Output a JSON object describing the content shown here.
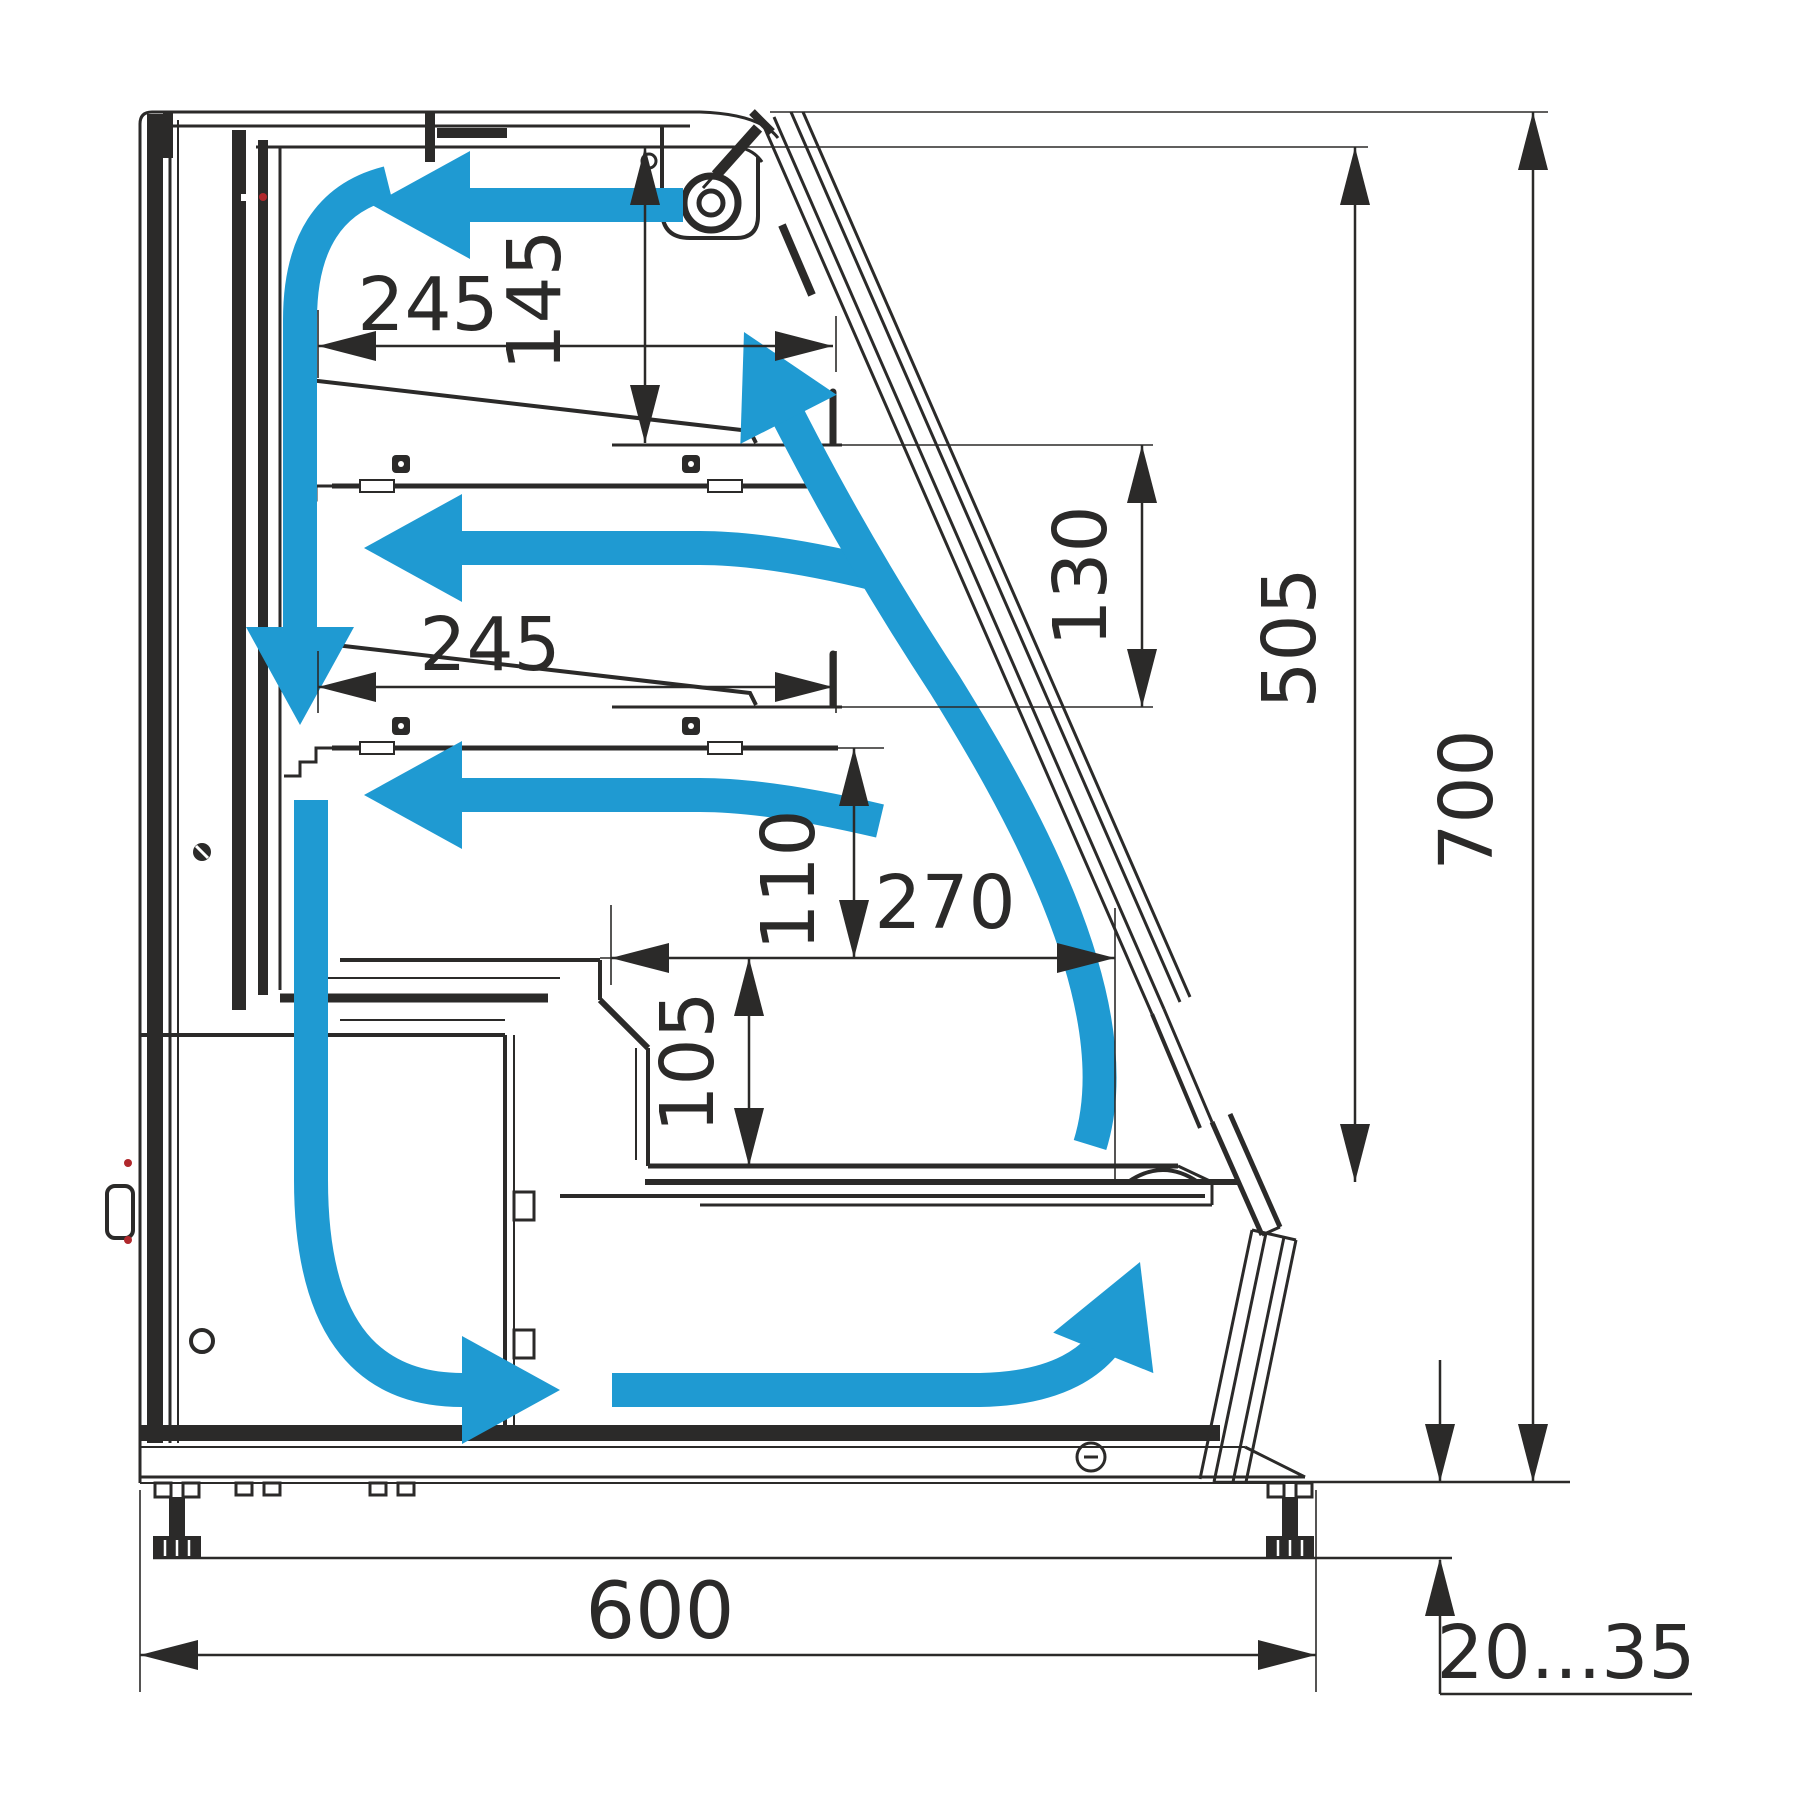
{
  "diagram": {
    "type": "technical-cross-section",
    "subject": "refrigerated-display-case-side-view-with-airflow",
    "colors": {
      "line": "#2b2a29",
      "airflow": "#1f9ad2",
      "accent_red": "#b0282c",
      "background": "#ffffff"
    },
    "dims": {
      "shelf_depth_upper": "245",
      "shelf_clearance_top": "145",
      "shelf_depth_lower": "245",
      "shelf_spacing": "130",
      "deck_clearance": "110",
      "well_length": "270",
      "well_depth": "105",
      "interior_height": "505",
      "overall_height": "700",
      "body_depth": "600",
      "ground_clearance": "20...35"
    },
    "icons": [
      "fan-icon",
      "airflow-arrow",
      "adjustable-foot",
      "dimension-arrow"
    ]
  }
}
